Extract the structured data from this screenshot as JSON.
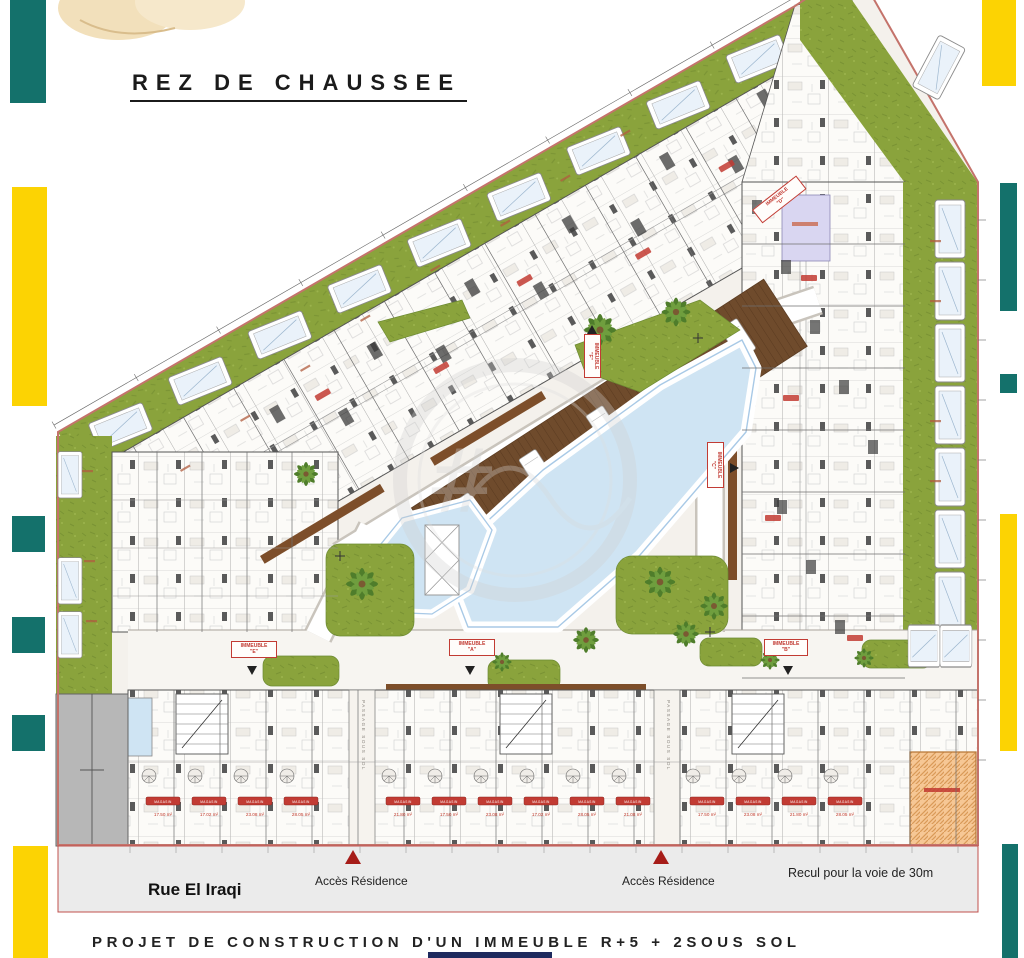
{
  "header": {
    "title": "REZ DE CHAUSSEE"
  },
  "footer": {
    "caption": "PROJET DE CONSTRUCTION D'UN IMMEUBLE R+5 + 2SOUS SOL"
  },
  "street": {
    "name": "Rue El Iraqi",
    "access_left": "Accès Résidence",
    "access_right": "Accès Résidence",
    "setback": "Recul pour la voie de 30m"
  },
  "plan": {
    "passage_label": "PASSAGE SOUS SOL",
    "immeubles": [
      {
        "line1": "IMMEUBLE",
        "line2": "\"E\""
      },
      {
        "line1": "IMMEUBLE",
        "line2": "\"A\""
      },
      {
        "line1": "IMMEUBLE",
        "line2": "\"B\""
      },
      {
        "line1": "IMMEUBLE",
        "line2": "\"C\""
      },
      {
        "line1": "IMMEUBLE",
        "line2": "\"F\""
      },
      {
        "line1": "IMMEUBLE",
        "line2": "\"D\""
      }
    ],
    "shop_badge": "MAGASIN",
    "shop_areas": [
      "17.50 m²",
      "17.02 m²",
      "23.08 m²",
      "28.05 m²",
      "21.80 m²",
      "17.50 m²",
      "23.08 m²",
      "17.02 m²",
      "28.05 m²",
      "21.08 m²",
      "17.50 m²",
      "23.08 m²",
      "21.80 m²",
      "28.05 m²"
    ]
  },
  "colors": {
    "accent_teal": "#14716b",
    "accent_yellow": "#fcd303",
    "grass_green": "#8aa33c",
    "pool_blue": "#cfe4f3",
    "deck_brown": "#6f4b2c",
    "boundary_red": "#c4736b",
    "ramp_orange": "#f6c795",
    "badge_red": "#c23b33",
    "street_gray": "#ebebeb"
  }
}
